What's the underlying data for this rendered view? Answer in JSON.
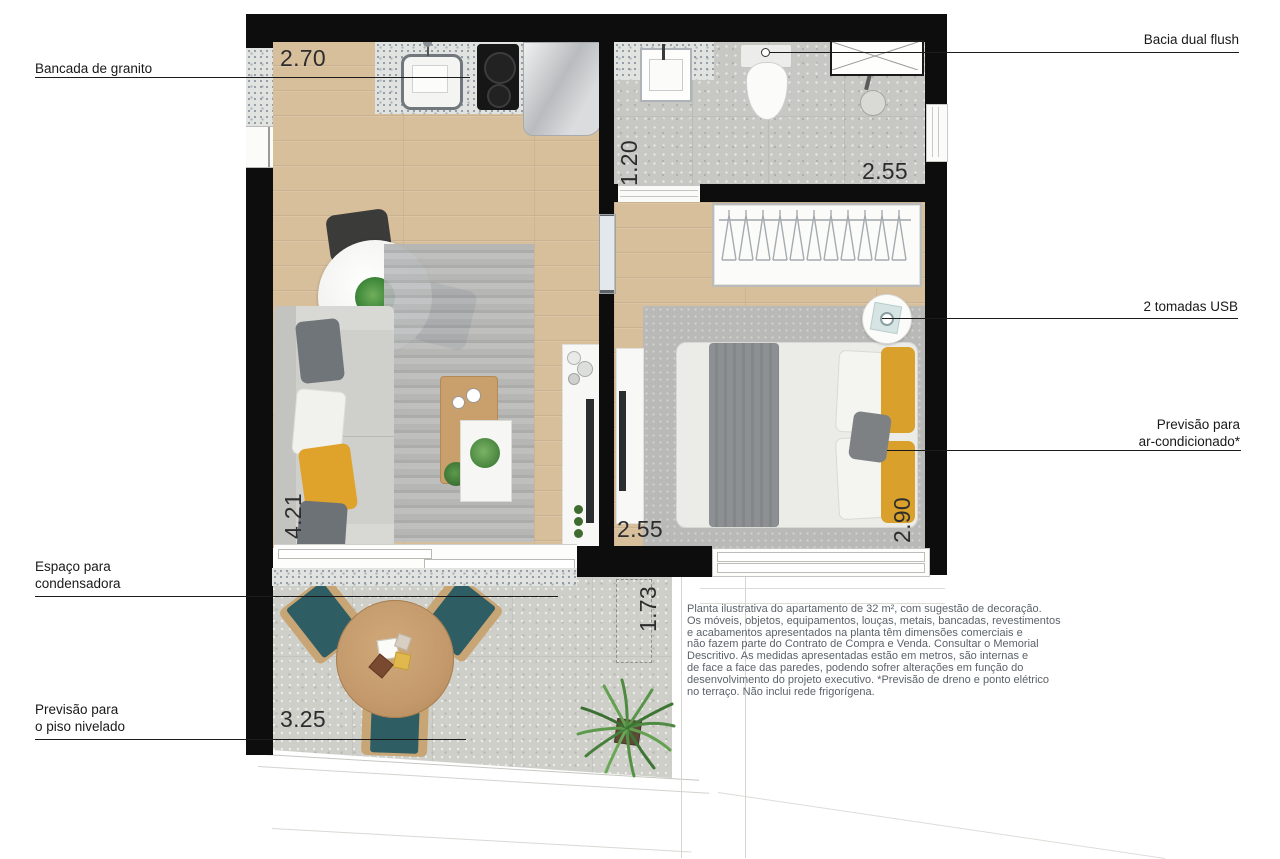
{
  "callouts": {
    "bancada_granito": "Bancada de granito",
    "bacia_dual_flush": "Bacia dual flush",
    "tomadas_usb": "2 tomadas USB",
    "ar_condicionado_l1": "Previsão para",
    "ar_condicionado_l2": "ar-condicionado*",
    "condensadora_l1": "Espaço para",
    "condensadora_l2": "condensadora",
    "piso_nivelado_l1": "Previsão para",
    "piso_nivelado_l2": "o piso nivelado"
  },
  "dims": {
    "kitchen_w": "2.70",
    "bath_d": "1.20",
    "bath_w": "2.55",
    "living_l": "4.21",
    "bedroom_w": "2.55",
    "bedroom_l": "2.90",
    "terrace_d": "1.73",
    "terrace_w": "3.25"
  },
  "disclaimer": {
    "l1": "Planta ilustrativa do apartamento de 32 m², com sugestão de decoração.",
    "l2": "Os móveis, objetos, equipamentos, louças, metais, bancadas, revestimentos",
    "l3": "e acabamentos apresentados na planta têm dimensões comerciais e",
    "l4": "não fazem parte do Contrato de Compra e Venda. Consultar o Memorial",
    "l5": "Descritivo. As medidas apresentadas estão em metros, são internas e",
    "l6": "de face a face das paredes, podendo sofrer alterações em função do",
    "l7": "desenvolvimento do projeto executivo. *Previsão de dreno e ponto elétrico",
    "l8": "no terraço. Não inclui rede frigorígena."
  },
  "colors": {
    "wall": "#0d0d0d",
    "wood_floor": "#d8bf9c",
    "concrete_floor": "#c7c8c4",
    "granite": "#e1e3e1",
    "accent_yellow": "#dfa32c",
    "chair_teal": "#2e5d63"
  }
}
